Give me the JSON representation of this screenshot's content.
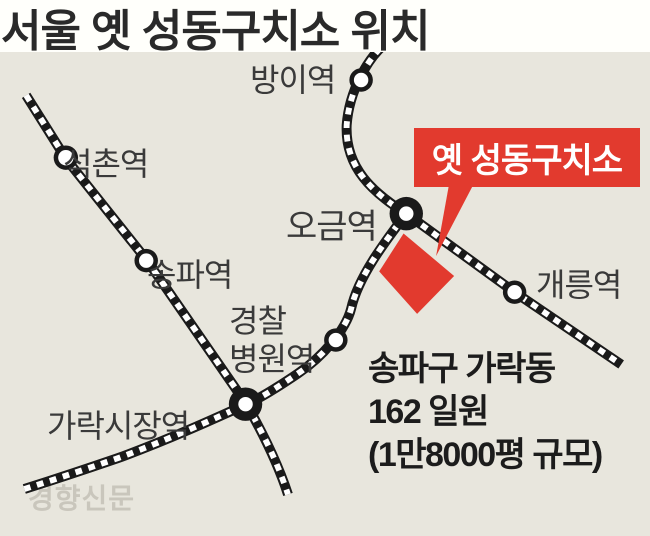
{
  "title": "서울 옛 성동구치소 위치",
  "callout": {
    "label": "옛 성동구치소",
    "color": "#e23a2e"
  },
  "stations": [
    {
      "name": "방이역",
      "type": "regular"
    },
    {
      "name": "석촌역",
      "type": "regular"
    },
    {
      "name": "송파역",
      "type": "regular"
    },
    {
      "name": "오금역",
      "type": "transfer"
    },
    {
      "name": "개릉역",
      "type": "regular"
    },
    {
      "name": "경찰병원역",
      "lines": [
        "경찰",
        "병원역"
      ],
      "type": "regular"
    },
    {
      "name": "가락시장역",
      "type": "transfer"
    }
  ],
  "site_note": {
    "line1": "송파구 가락동",
    "line2": "162 일원",
    "line3": "(1만8000평 규모)"
  },
  "source_logo": "경향신문",
  "colors": {
    "map_background": "#e8e6dd",
    "rail_line": "#1a1a1a",
    "accent_red": "#e23a2e",
    "station_label": "#3a3a3a"
  }
}
